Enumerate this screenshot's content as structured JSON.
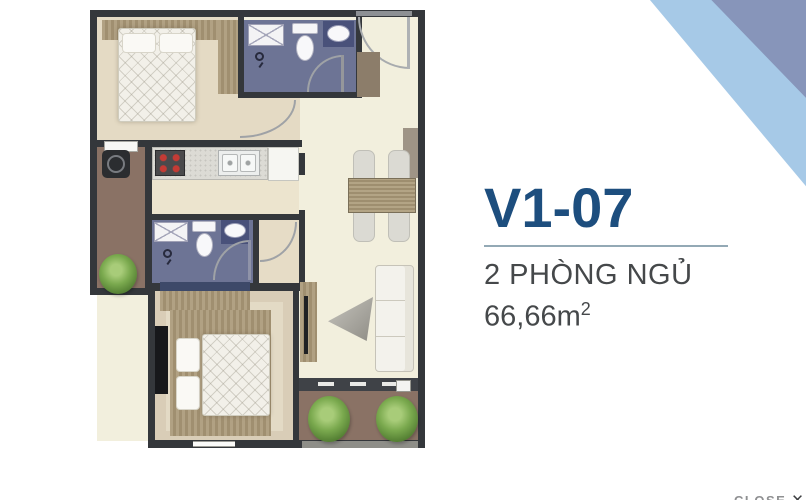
{
  "unit_panel": {
    "code": "V1-07",
    "bedrooms_label": "2 PHÒNG NGỦ",
    "area_value": "66,66m",
    "area_sup": "2"
  },
  "close_button": {
    "label": "CLOSE",
    "icon": "✕"
  },
  "colors": {
    "accent": "#1d4e7e",
    "text": "#45484a",
    "divider": "#93a9b5",
    "ribbon_light": "#a6c9e7",
    "ribbon_dark": "#8795ba",
    "wall": "#34373b",
    "floor": "#f2efdd",
    "bedroom_floor": "#e4dac4",
    "bath_floor": "#6d7495",
    "balcony_floor": "#8a7265",
    "close_text": "#8f9092",
    "close_icon": "#3c3e40"
  }
}
